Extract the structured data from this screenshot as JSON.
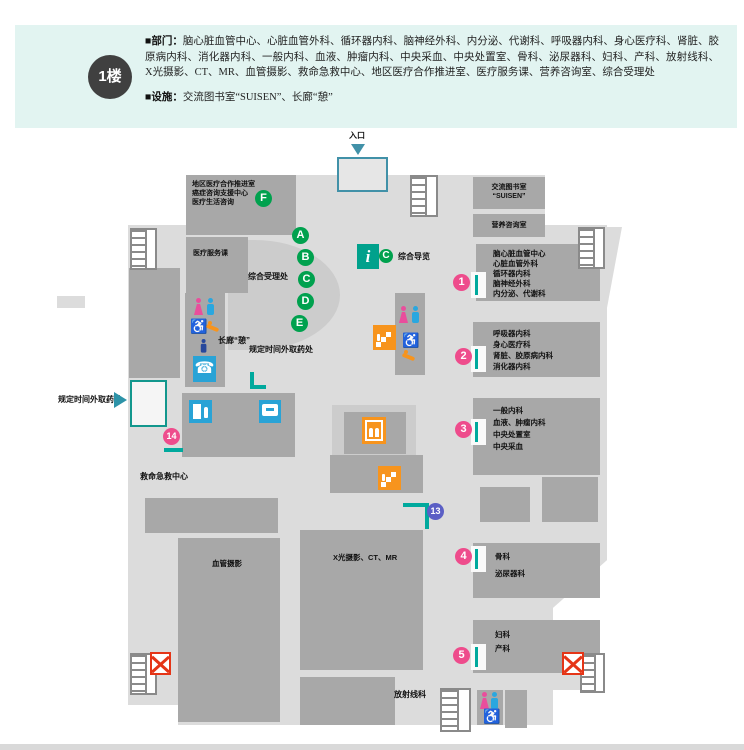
{
  "header": {
    "floor": "1楼",
    "dept_label": "■部门：",
    "departments": "脑心脏血管中心、心脏血管外科、循环器内科、脑神经外科、内分泌、代谢科、呼吸器内科、身心医疗科、肾脏、胶原病内科、消化器内科、一般内科、血液、肿瘤内科、中央采血、中央处置室、骨科、泌尿器科、妇科、产科、放射线科、X光摄影、CT、MR、血管摄影、救命急救中心、地区医疗合作推进室、医疗服务课、营养咨询室、综合受理处",
    "fac_label": "■设施：",
    "facilities": "交流图书室“SUISEN”、长廊“憩”"
  },
  "map": {
    "entrance": "入口",
    "guide": {
      "i": "i",
      "c": "C",
      "label": "综合导览"
    },
    "reception": "综合受理处",
    "corridor": "长廊“憩”",
    "pickup_mid": "规定时间外取药处",
    "pickup_left": "规定时间外取药处",
    "emergency": "救命急救中心",
    "vascular": "血管摄影",
    "xray": "X光摄影、CT、MR",
    "radiology": "放射线科",
    "rooms": {
      "coop": [
        "地区医疗合作推进室",
        "癌症咨询支援中心",
        "医疗生活咨询"
      ],
      "service": "医疗服务课",
      "suisen": [
        "交流图书室",
        "“SUISEN”"
      ],
      "nutrition": "营养咨询室",
      "r1": [
        "脑心脏血管中心",
        "心脏血管外科",
        "循环器内科",
        "脑神经外科",
        "内分泌、代谢科"
      ],
      "r2": [
        "呼吸器内科",
        "身心医疗科",
        "肾脏、胶原病内科",
        "消化器内科"
      ],
      "r3": [
        "一般内科",
        "血液、肿瘤内科",
        "中央处置室",
        "中央采血"
      ],
      "r4": [
        "骨科",
        "泌尿器科"
      ],
      "r5": [
        "妇科",
        "产科"
      ]
    },
    "markers": {
      "a": "A",
      "b": "B",
      "c": "C",
      "d": "D",
      "e": "E",
      "f": "F",
      "n1": "1",
      "n2": "2",
      "n3": "3",
      "n4": "4",
      "n5": "5",
      "n13": "13",
      "n14": "14"
    },
    "icons": {
      "phone": "☎",
      "wheelchair": "♿"
    }
  },
  "colors": {
    "header_bg": "#e2f4f1",
    "floor": "#dcdcdc",
    "room": "#a8a8a8",
    "green": "#00a14e",
    "pink": "#ee4c8c",
    "marker_blue": "#5b5fc5",
    "teal": "#00a99d",
    "orange": "#f7941d",
    "icon_blue": "#29a3d6",
    "red": "#e53517",
    "entrance_border": "#4191a8"
  }
}
